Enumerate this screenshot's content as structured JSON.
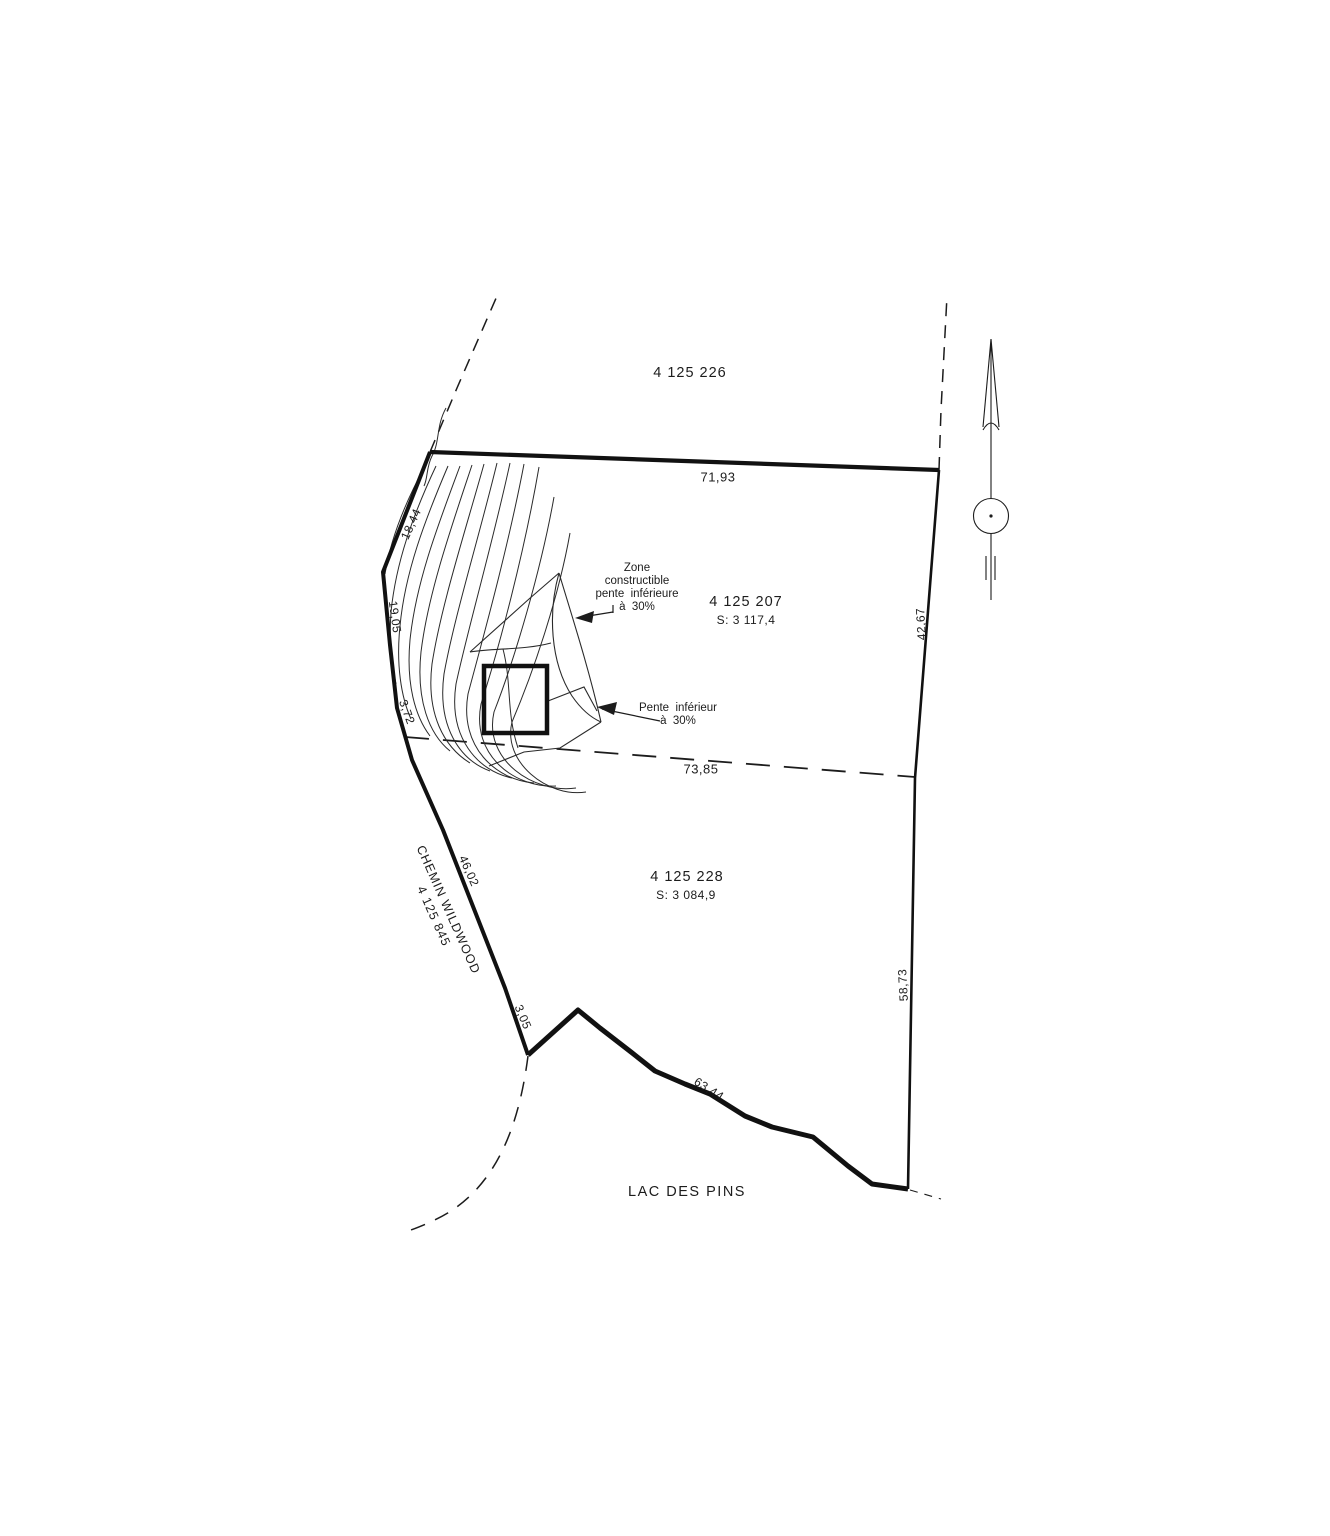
{
  "page": {
    "background": "#ffffff",
    "ink": "#1c1c1c"
  },
  "parcels": {
    "north": {
      "number": "4 125 226"
    },
    "center": {
      "number": "4 125 207",
      "area": "S: 3 117,4"
    },
    "south": {
      "number": "4 125 228",
      "area": "S: 3 084,9"
    },
    "road": {
      "number": "4 125 845"
    }
  },
  "road": {
    "name": "CHEMIN WILDWOOD"
  },
  "lake": {
    "name": "LAC DES PINS"
  },
  "notes": {
    "zone_constructible": {
      "l1": "Zone",
      "l2": "constructible",
      "l3": "pente  inférieure",
      "l4": "à  30%"
    },
    "pente": {
      "l1": "Pente  inférieur",
      "l2": "à  30%"
    }
  },
  "dimensions": {
    "top": "71,93",
    "division": "73,85",
    "right_upper": "42,67",
    "right_lower": "58,73",
    "shore": "63,44",
    "northwest": "18,44",
    "west_upper": "19,05",
    "west_mid": "3,72",
    "west_road": "46,02",
    "west_lower": "3,05"
  },
  "icons": {
    "north_arrow": "north-arrow"
  }
}
